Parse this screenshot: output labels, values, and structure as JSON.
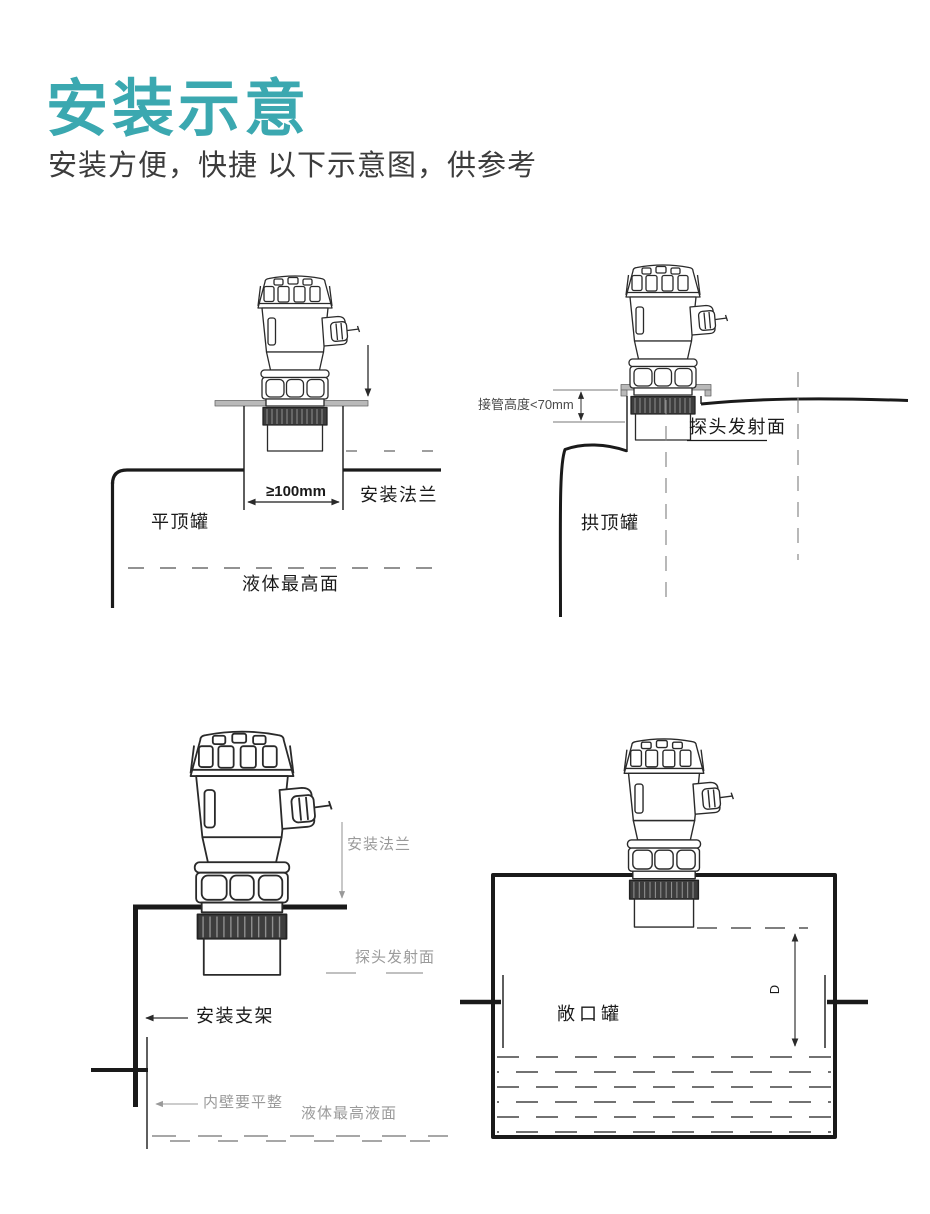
{
  "header": {
    "title": "安装示意",
    "subtitle": "安装方便，快捷 以下示意图，供参考"
  },
  "colors": {
    "accent_teal": "#3BA8B0",
    "subtitle_gray": "#3C3C3C",
    "line_black": "#1A1A1A",
    "label_gray": "#9A9A9A"
  },
  "diagrams": {
    "flat_top_tank": {
      "tank_label": "平顶罐",
      "flange_gap_dimension": "≥100mm",
      "flange_label": "安装法兰",
      "max_liquid_label": "液体最高面"
    },
    "arch_top_tank": {
      "tank_label": "拱顶罐",
      "nozzle_height_dimension": "接管高度<70mm",
      "probe_face_label": "探头发射面"
    },
    "bracket_mount": {
      "flange_label": "安装法兰",
      "probe_face_label": "探头发射面",
      "bracket_label": "安装支架",
      "inner_wall_note": "内壁要平整",
      "max_liquid_label": "液体最高液面"
    },
    "open_tank": {
      "tank_label": "敞口罐",
      "measure_distance_label": "D"
    }
  }
}
